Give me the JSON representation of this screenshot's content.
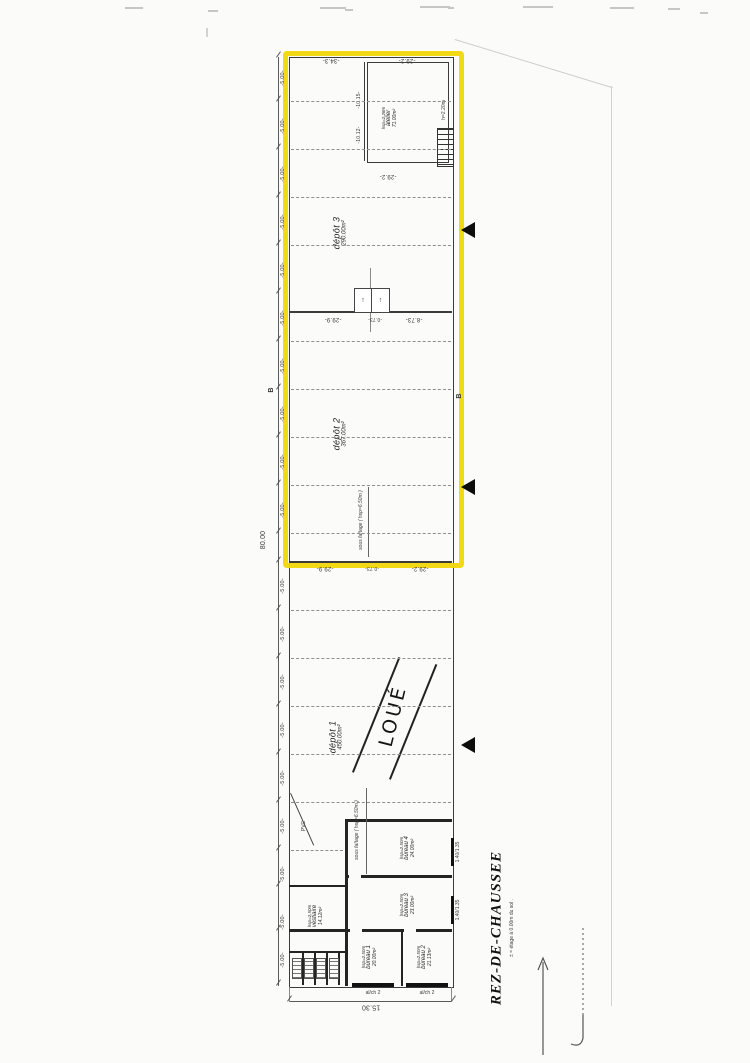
{
  "drawing": {
    "title": "REZ-DE-CHAUSSEE",
    "title_note": "± = étage à 0.00m du sol .",
    "handwritten_loue": "LOUÉ",
    "rooms": {
      "atelier": {
        "height": "hsp=2.28m",
        "name": "atelier",
        "area": "71.00m²"
      },
      "depot3": {
        "name": "dépôt 3",
        "area": "290.00m²"
      },
      "depot2": {
        "name": "dépôt 2",
        "area": "367.00m²"
      },
      "depot1": {
        "name": "dépôt 1",
        "area": "450.00m²"
      },
      "bureau4": {
        "height": "hsp=2.50m",
        "name": "bureau 4",
        "area": "24.00m²"
      },
      "bureau3": {
        "height": "hsp=2.50m",
        "name": "bureau 3",
        "area": "23.00m²"
      },
      "bureau2": {
        "height": "hsp=2.50m",
        "name": "bureau 2",
        "area": "21.13m²"
      },
      "bureau1": {
        "height": "hsp=2.50m",
        "name": "bureau 1",
        "area": "20.00m²"
      },
      "vestiaire": {
        "height": "hsp=2.50m",
        "name": "vestiaire",
        "area": "14.12m²"
      }
    },
    "annotations": {
      "faitage": "sous faîtage ( hsp=6.50m )",
      "pvc": "PVC",
      "stair": "h=2.20m",
      "window_label": "al/ch 2",
      "window_dim": "1.40/1.35",
      "section_marker": "B"
    },
    "dims": {
      "total_height": "80.00",
      "total_width": "15.30",
      "bay": "-5.00-",
      "d34_3": "-34.3-",
      "d29_2": "-29.2-",
      "d29_9": "-29.9-",
      "d0_73": "-0.73-",
      "d8_73": "-8.73-",
      "d10_15": "-10.15-",
      "d10_12": "-10.12-"
    },
    "colors": {
      "highlight": "#f2d608"
    }
  }
}
